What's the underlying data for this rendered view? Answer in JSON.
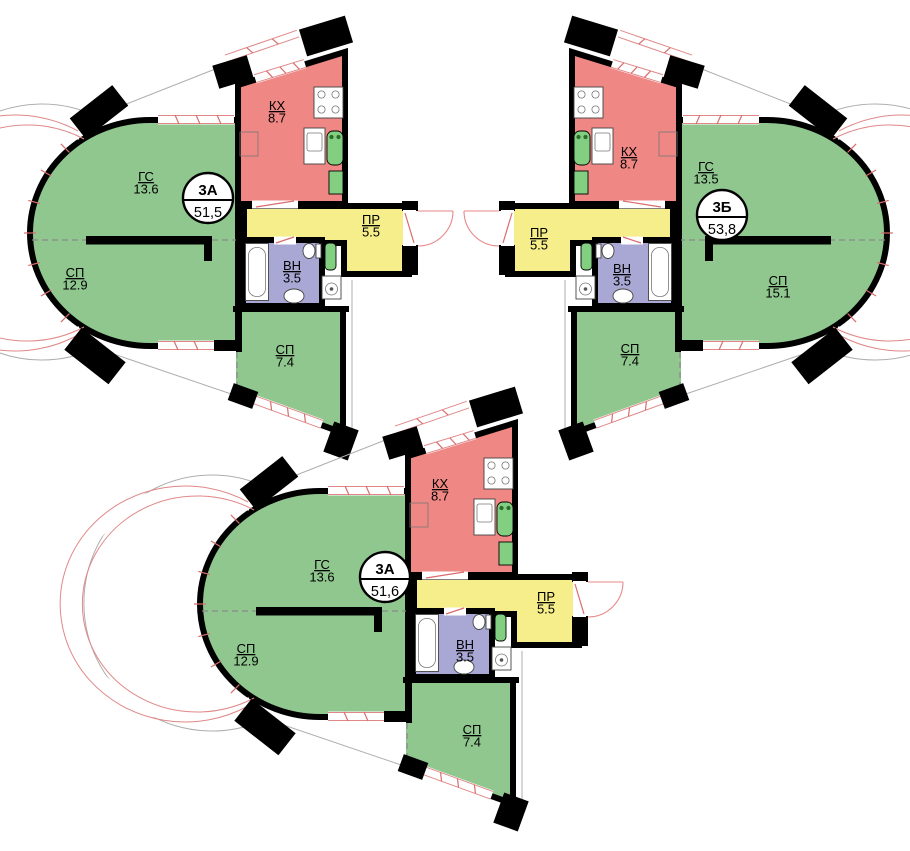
{
  "palette": {
    "room_green": "#90c78f",
    "kitchen_red": "#ef8784",
    "hall_yellow": "#f5ee8a",
    "bath_purple": "#a9a8d5",
    "fixture_green": "#82cf82",
    "wall_black": "#000000",
    "window_pink": "#e08888"
  },
  "apartments": [
    {
      "badge": {
        "type": "3А",
        "total": "51,5"
      },
      "rooms": {
        "living": {
          "code": "ГС",
          "area": "13.6"
        },
        "bedroom_main": {
          "code": "СП",
          "area": "12.9"
        },
        "kitchen": {
          "code": "КХ",
          "area": "8.7"
        },
        "hall": {
          "code": "ПР",
          "area": "5.5"
        },
        "bath": {
          "code": "ВН",
          "area": "3.5"
        },
        "bedroom_second": {
          "code": "СП",
          "area": "7.4"
        }
      }
    },
    {
      "badge": {
        "type": "3Б",
        "total": "53,8"
      },
      "rooms": {
        "living": {
          "code": "ГС",
          "area": "13.5"
        },
        "bedroom_main": {
          "code": "СП",
          "area": "15.1"
        },
        "kitchen": {
          "code": "КХ",
          "area": "8.7"
        },
        "hall": {
          "code": "ПР",
          "area": "5.5"
        },
        "bath": {
          "code": "ВН",
          "area": "3.5"
        },
        "bedroom_second": {
          "code": "СП",
          "area": "7.4"
        }
      }
    },
    {
      "badge": {
        "type": "3А",
        "total": "51,6"
      },
      "rooms": {
        "living": {
          "code": "ГС",
          "area": "13.6"
        },
        "bedroom_main": {
          "code": "СП",
          "area": "12.9"
        },
        "kitchen": {
          "code": "КХ",
          "area": "8.7"
        },
        "hall": {
          "code": "ПР",
          "area": "5.5"
        },
        "bath": {
          "code": "ВН",
          "area": "3.5"
        },
        "bedroom_second": {
          "code": "СП",
          "area": "7.4"
        }
      }
    }
  ]
}
